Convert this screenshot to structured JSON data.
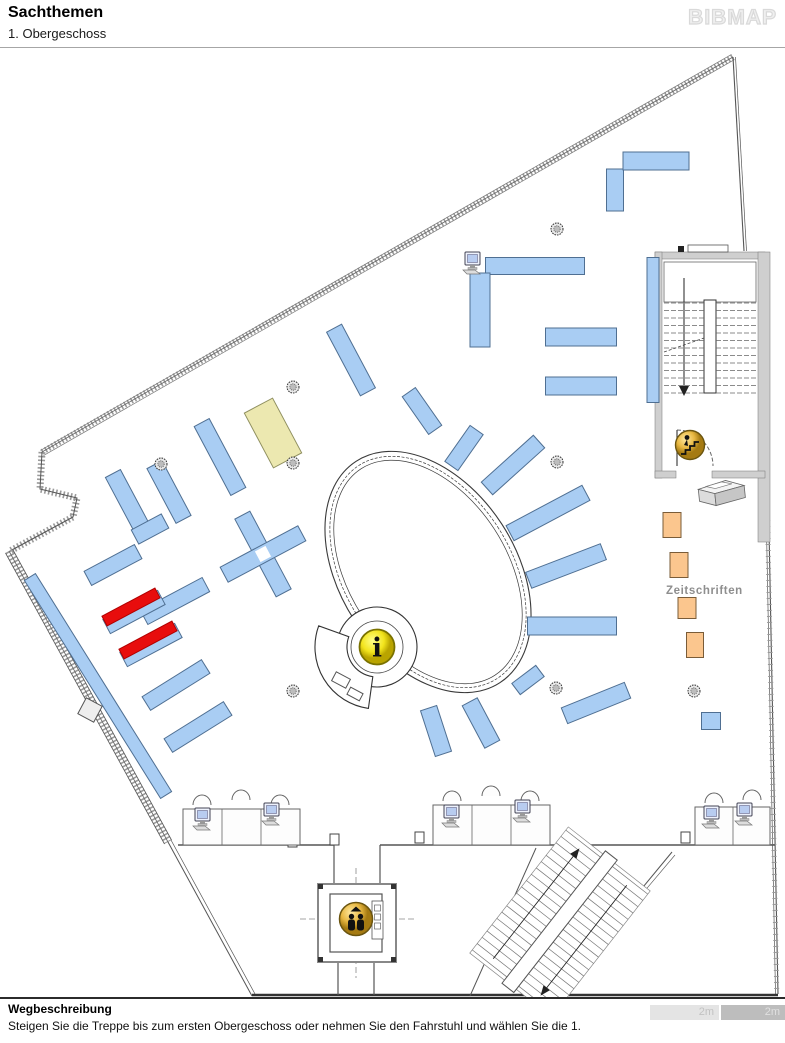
{
  "header": {
    "title": "Sachthemen",
    "subtitle": "1. Obergeschoss",
    "logo": "BIBMAP"
  },
  "footer": {
    "heading": "Wegbeschreibung",
    "description": "Steigen Sie die Treppe bis zum ersten Obergeschoss oder nehmen Sie den Fahrstuhl und wählen Sie die 1.",
    "scale": [
      {
        "label": "2m",
        "bg": "#e4e4e4",
        "fg": "#c2c2c2"
      },
      {
        "label": "2m",
        "bg": "#bdbdbd",
        "fg": "#e0e0e0"
      }
    ]
  },
  "map": {
    "labels": {
      "zeitschriften": {
        "text": "Zeitschriften",
        "x": 666,
        "y": 594
      }
    },
    "colors": {
      "shelf": "#a9cdf3",
      "shelf_border": "#4f6f92",
      "highlight": "#e80d0d",
      "beige": "#ece8b0",
      "beige_border": "#8f8f5f",
      "orange": "#fbc68e",
      "orange_border": "#7a5c38",
      "wall": "#555555",
      "icon_gold": "#e8b842",
      "icon_yellow": "#f2e41c"
    },
    "outline": [
      [
        733,
        57
      ],
      [
        777,
        994
      ],
      [
        252,
        994
      ],
      [
        168,
        842
      ],
      [
        9,
        552
      ],
      [
        73,
        517
      ],
      [
        77,
        498
      ],
      [
        40,
        489
      ],
      [
        42,
        452
      ]
    ],
    "shelves_blue": [
      [
        615,
        190,
        42,
        17,
        90
      ],
      [
        656,
        161,
        66,
        18,
        0
      ],
      [
        535,
        266,
        99,
        17,
        0
      ],
      [
        480,
        310,
        74,
        20,
        90
      ],
      [
        581,
        337,
        71,
        18,
        0
      ],
      [
        581,
        386,
        71,
        18,
        0
      ],
      [
        653,
        330,
        145,
        12,
        90
      ],
      [
        351,
        360,
        72,
        17,
        62
      ],
      [
        422,
        411,
        46,
        16,
        55
      ],
      [
        464,
        448,
        44,
        16,
        -55
      ],
      [
        513,
        465,
        70,
        17,
        -42
      ],
      [
        548,
        513,
        86,
        17,
        -28
      ],
      [
        566,
        566,
        80,
        17,
        -21
      ],
      [
        572,
        626,
        89,
        18,
        0
      ],
      [
        528,
        680,
        30,
        14,
        -37
      ],
      [
        596,
        703,
        68,
        17,
        -22
      ],
      [
        436,
        731,
        48,
        17,
        72
      ],
      [
        481,
        723,
        48,
        17,
        62
      ],
      [
        263,
        554,
        88,
        17,
        62
      ],
      [
        263,
        554,
        88,
        17,
        -28
      ],
      [
        127,
        500,
        60,
        17,
        62
      ],
      [
        169,
        492,
        62,
        17,
        62
      ],
      [
        150,
        529,
        34,
        16,
        -28
      ],
      [
        113,
        565,
        57,
        16,
        -28
      ],
      [
        220,
        457,
        78,
        17,
        62
      ],
      [
        175,
        601,
        70,
        16,
        -28
      ],
      [
        134,
        612,
        62,
        16,
        -28
      ],
      [
        151,
        645,
        62,
        16,
        -28
      ],
      [
        176,
        685,
        70,
        16,
        -32
      ],
      [
        198,
        727,
        70,
        16,
        -32
      ],
      [
        98,
        686,
        257,
        13,
        58
      ],
      [
        711,
        721,
        19,
        17,
        0
      ]
    ],
    "shelves_red": [
      [
        131,
        607,
        60,
        11,
        -28
      ],
      [
        148,
        640,
        60,
        11,
        -28
      ]
    ],
    "cross_gap": [
      263,
      554,
      12,
      62
    ],
    "shelf_beige": [
      273,
      433,
      62,
      32,
      62
    ],
    "shelves_orange": [
      [
        672,
        525,
        18,
        25
      ],
      [
        679,
        565,
        18,
        25
      ],
      [
        687,
        608,
        18,
        21
      ],
      [
        695,
        645,
        17,
        25
      ]
    ],
    "columns": [
      [
        557,
        229
      ],
      [
        293,
        387
      ],
      [
        161,
        464
      ],
      [
        293,
        463
      ],
      [
        557,
        462
      ],
      [
        293,
        691
      ],
      [
        556,
        688
      ],
      [
        694,
        691
      ]
    ],
    "computers": [
      [
        473,
        262
      ],
      [
        203,
        818
      ],
      [
        272,
        813
      ],
      [
        452,
        815
      ],
      [
        523,
        810
      ],
      [
        712,
        816
      ],
      [
        745,
        813
      ]
    ],
    "chairs": [
      [
        202,
        798
      ],
      [
        241,
        793
      ],
      [
        280,
        798
      ],
      [
        452,
        794
      ],
      [
        491,
        789
      ],
      [
        530,
        794
      ],
      [
        714,
        796
      ],
      [
        752,
        793
      ]
    ],
    "icons": {
      "info": {
        "x": 377,
        "y": 647,
        "glyph": "i"
      },
      "elevator": {
        "x": 356,
        "y": 919
      },
      "stairs_down": {
        "x": 690,
        "y": 445
      },
      "printer": {
        "x": 721,
        "y": 495
      }
    }
  }
}
